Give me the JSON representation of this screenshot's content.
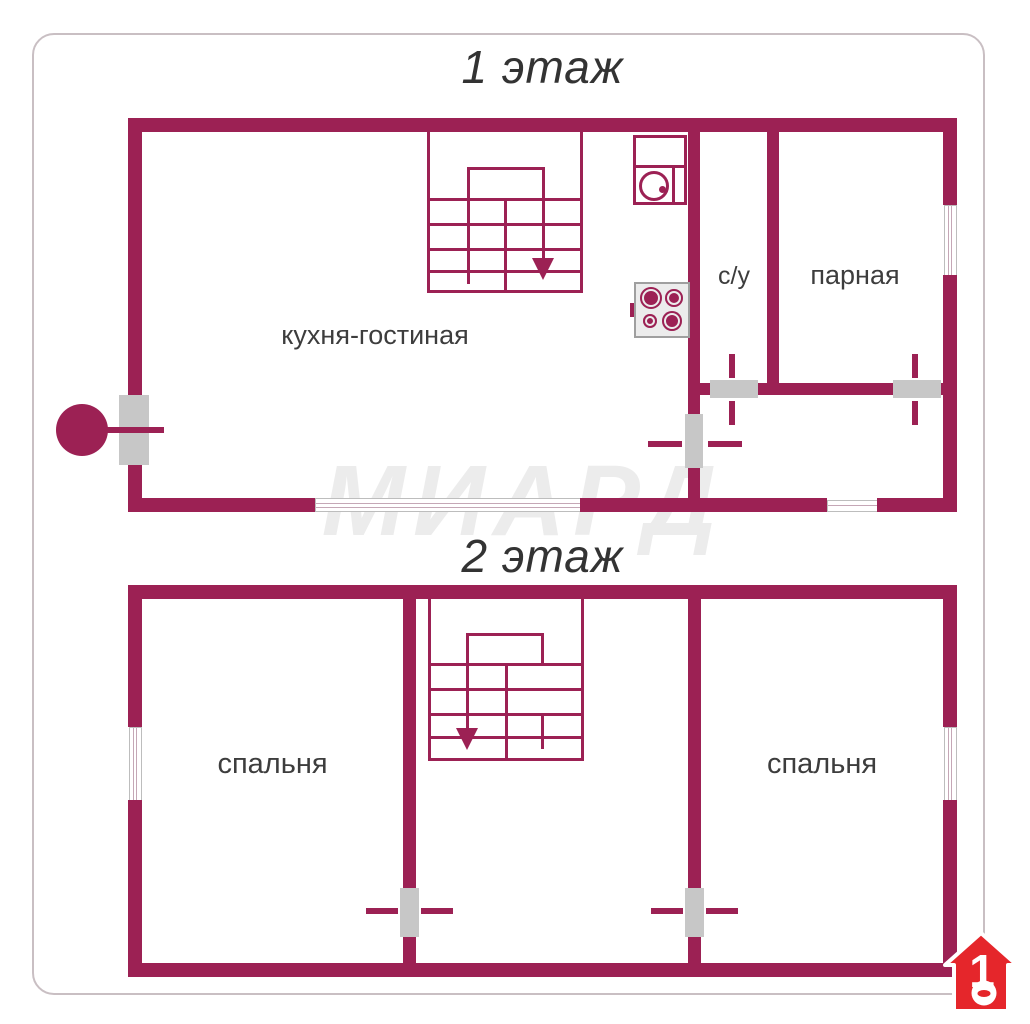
{
  "colors": {
    "wall": "#9c2154",
    "door_gray": "#c7c7c7",
    "fixture_border": "#9f9f9f",
    "fixture_bg": "#ececec",
    "text": "#3d3d3d",
    "title": "#333333",
    "watermark": "#ececec",
    "logo_red": "#e5262b",
    "card_border": "#c9bfc3",
    "window_line": "#c5a7b6"
  },
  "floor1": {
    "title": "1 этаж",
    "rooms": {
      "kitchen_living": "кухня-гостиная",
      "bathroom": "с/у",
      "steam_room": "парная"
    }
  },
  "floor2": {
    "title": "2 этаж",
    "rooms": {
      "bedroom_left": "спальня",
      "bedroom_right": "спальня"
    }
  },
  "watermark": {
    "text": "МИАРД"
  },
  "logo": {
    "number": "1"
  }
}
